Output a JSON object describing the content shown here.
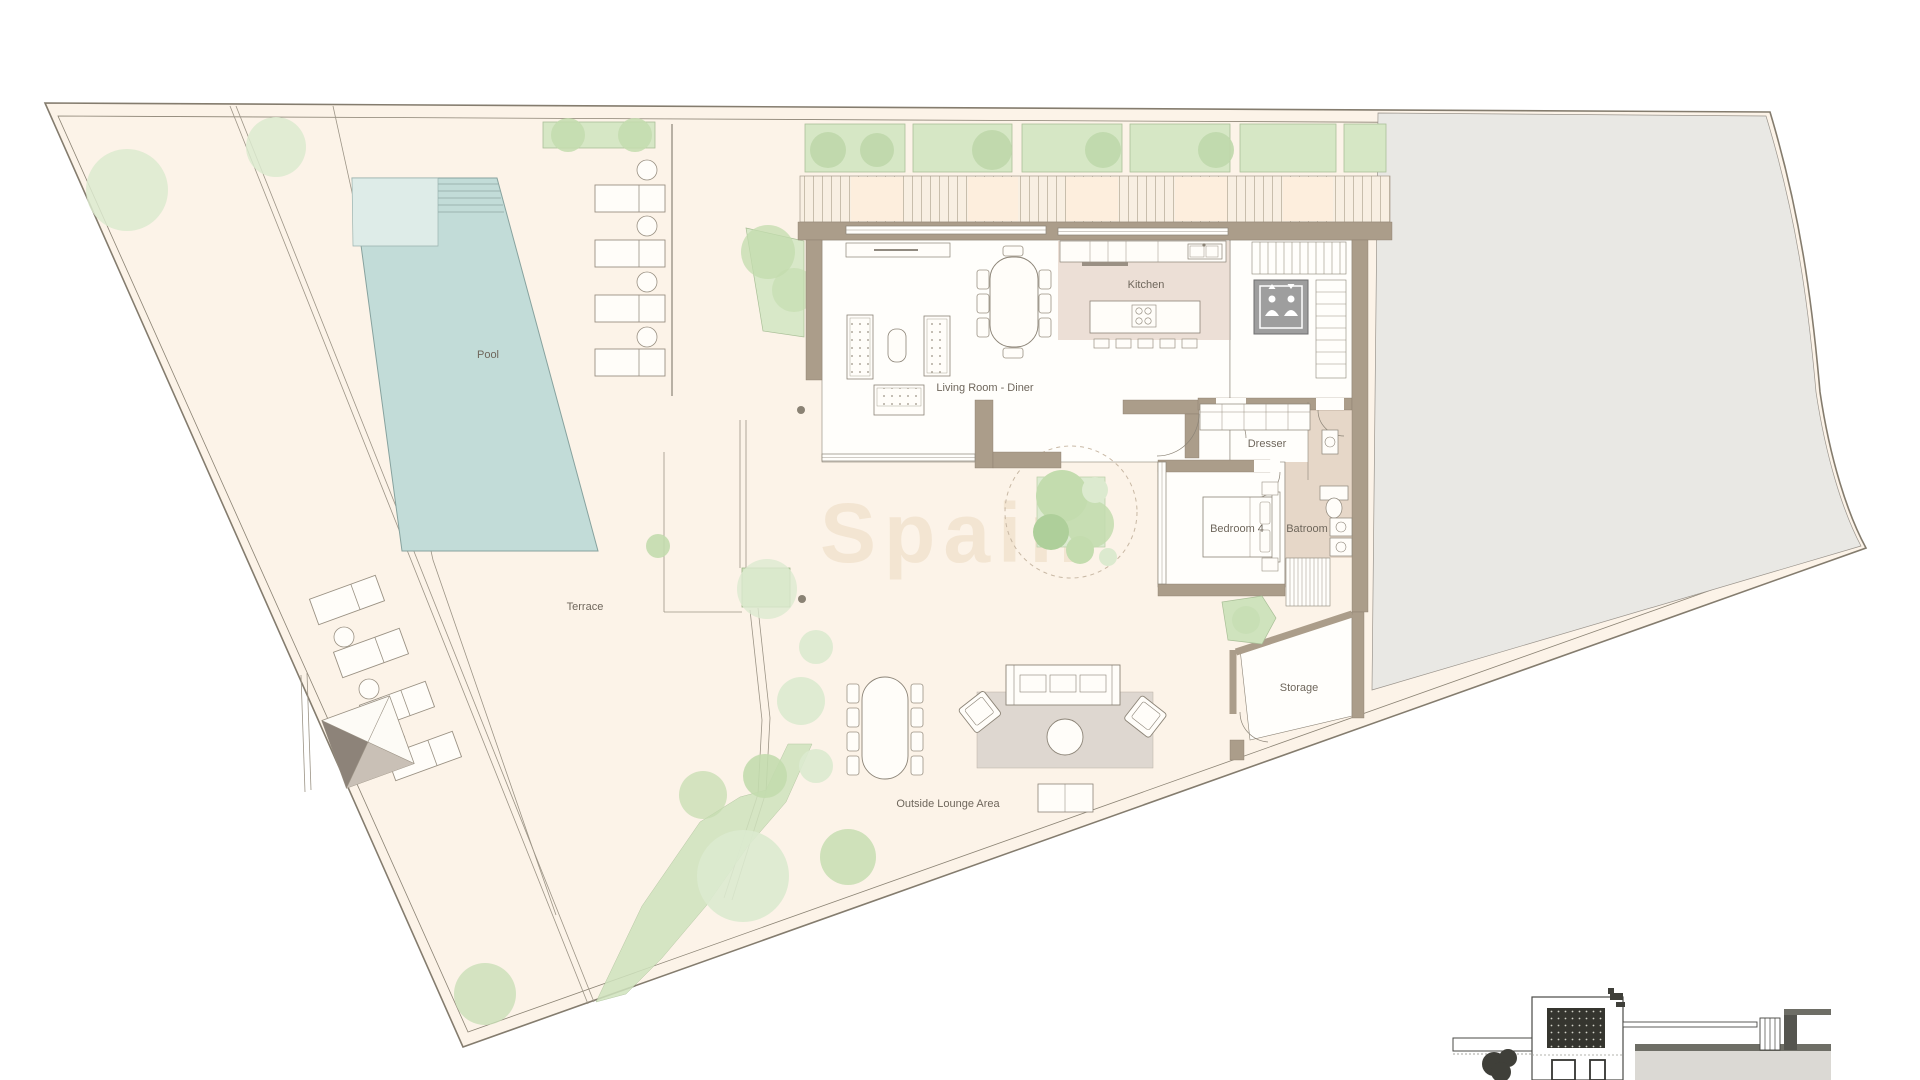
{
  "plan": {
    "title": "Villa ground floor site plan",
    "labels": {
      "pool": "Pool",
      "terrace": "Terrace",
      "living_room": "Living Room - Diner",
      "kitchen": "Kitchen",
      "dresser": "Dresser",
      "bedroom4": "Bedroom 4",
      "bathroom": "Batroom",
      "storage": "Storage",
      "outside_lounge": "Outside Lounge Area"
    },
    "watermark": "Spain"
  },
  "colors": {
    "site_fill": "#fcf3e8",
    "panel_peach": "#fdeedd",
    "boundary_line": "#8b8374",
    "pool_water": "#c2dcd8",
    "pool_shallow": "#deece8",
    "wall": "#ab9d8a",
    "kitchen_floor": "#ecdfd6",
    "bathroom_floor": "#e6d7c8",
    "rug": "#ded7d0",
    "east_area": "#e9e8e4",
    "green_light": "#dceacf",
    "green_mid": "#c3dcae",
    "planter_fill": "#d6e7c5",
    "elevator_fill": "#9e9e9e",
    "label_color": "#6f675c"
  }
}
